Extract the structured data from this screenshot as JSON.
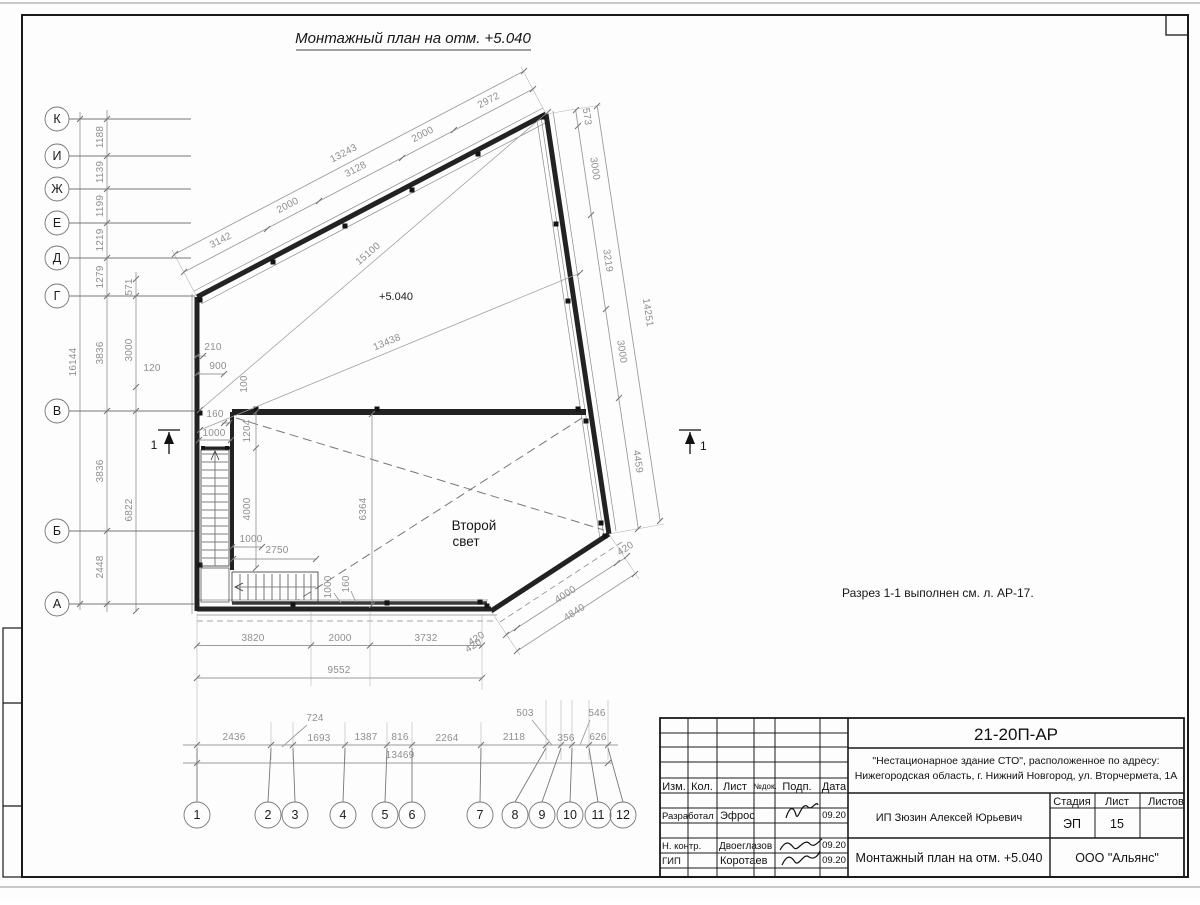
{
  "sheet": {
    "title": "Монтажный план на отм. +5.040",
    "note": "Разрез 1-1 выполнен см. л. АР-17.",
    "elevation": "+5.040",
    "room_line1": "Второй",
    "room_line2": "свет",
    "section_no": "1"
  },
  "axes": {
    "rows": [
      "К",
      "И",
      "Ж",
      "Е",
      "Д",
      "Г",
      "В",
      "Б",
      "А"
    ],
    "cols": [
      "1",
      "2",
      "3",
      "4",
      "5",
      "6",
      "7",
      "8",
      "9",
      "10",
      "11",
      "12"
    ]
  },
  "dims": {
    "row_spacing": [
      "1188",
      "1139",
      "1199",
      "1219",
      "1279",
      "3836",
      "3836",
      "2448"
    ],
    "row_total": "16144",
    "col2": [
      "571",
      "3000",
      "6822",
      "120"
    ],
    "top_seg": [
      "3142",
      "2000",
      "3128",
      "2000",
      "2972"
    ],
    "top_total": "13243",
    "diag_top": "15100",
    "diag_mid": "13438",
    "right_seg": [
      "573",
      "3000",
      "3219",
      "3000",
      "4459"
    ],
    "right_total": "14251",
    "stair": [
      "210",
      "900",
      "100",
      "160",
      "1000",
      "1204",
      "4000",
      "1000",
      "2750",
      "1000",
      "160"
    ],
    "room_height": "6364",
    "bottom_seg": [
      "3820",
      "2000",
      "3732",
      "420"
    ],
    "bottom_total": "9552",
    "chamfer_seg": [
      "420",
      "4000",
      "420"
    ],
    "chamfer_total": "4840",
    "grid_seg": [
      "2436",
      "724",
      "1693",
      "1387",
      "816",
      "2264",
      "2118",
      "503",
      "356",
      "546",
      "626"
    ],
    "grid_total": "13469"
  },
  "titleblock": {
    "doc_number": "21-20П-АР",
    "project_line1": "\"Нестационарное здание СТО\", расположенное по адресу:",
    "project_line2": "Нижегородская область, г. Нижний Новгород, ул. Вторчермета, 1А",
    "col_headers": [
      "Изм.",
      "Кол.",
      "Лист",
      "№док.",
      "Подп.",
      "Дата"
    ],
    "roles": [
      "Разработал",
      "Н. контр.",
      "ГИП"
    ],
    "names": [
      "Эфрос",
      "Двоеглазов",
      "Коротаев"
    ],
    "dates": [
      "09.20",
      "09.20",
      "09.20"
    ],
    "client": "ИП Зюзин Алексей Юрьевич",
    "stage_header": "Стадия",
    "sheet_header": "Лист",
    "sheets_header": "Листов",
    "stage_value": "ЭП",
    "sheet_value": "15",
    "drawing_title": "Монтажный план на отм. +5.040",
    "company": "ООО \"Альянс\""
  }
}
